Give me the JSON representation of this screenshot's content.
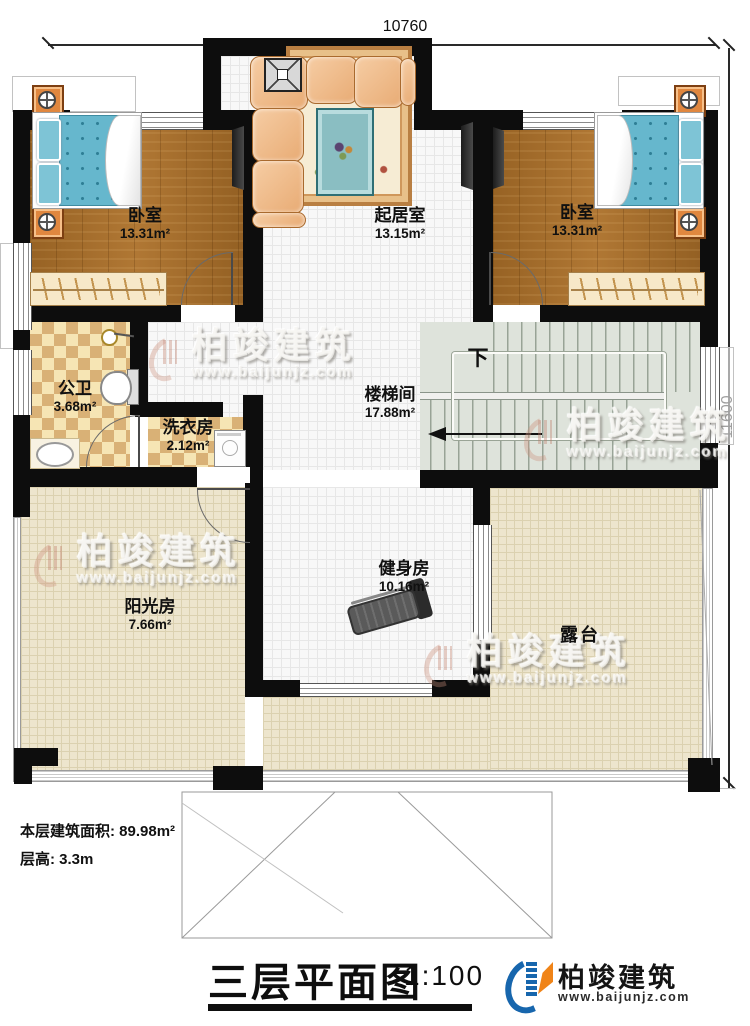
{
  "dimensions": {
    "top": "10760",
    "right": "11600"
  },
  "rooms": {
    "bedroom_left": {
      "name": "卧室",
      "area": "13.31m²"
    },
    "living": {
      "name": "起居室",
      "area": "13.15m²"
    },
    "bedroom_right": {
      "name": "卧室",
      "area": "13.31m²"
    },
    "bathroom": {
      "name": "公卫",
      "area": "3.68m²"
    },
    "laundry": {
      "name": "洗衣房",
      "area": "2.12m²"
    },
    "stairwell": {
      "name": "楼梯间",
      "area": "17.88m²",
      "direction": "下"
    },
    "gym": {
      "name": "健身房",
      "area": "10.16m²"
    },
    "sunroom": {
      "name": "阳光房",
      "area": "7.66m²"
    },
    "terrace": {
      "name": "露台"
    }
  },
  "info": {
    "floor_area": "本层建筑面积: 89.98m²",
    "floor_height": "层高: 3.3m"
  },
  "title": {
    "text": "三层平面图",
    "scale": "1:100"
  },
  "brand": {
    "name": "柏竣建筑",
    "url": "www.baijunjz.com"
  },
  "watermark": {
    "name": "柏竣建筑",
    "url": "www.baijunjz.com"
  },
  "colors": {
    "wall": "#0d0d0d",
    "brand_blue": "#1766ad",
    "brand_orange": "#f08418"
  }
}
